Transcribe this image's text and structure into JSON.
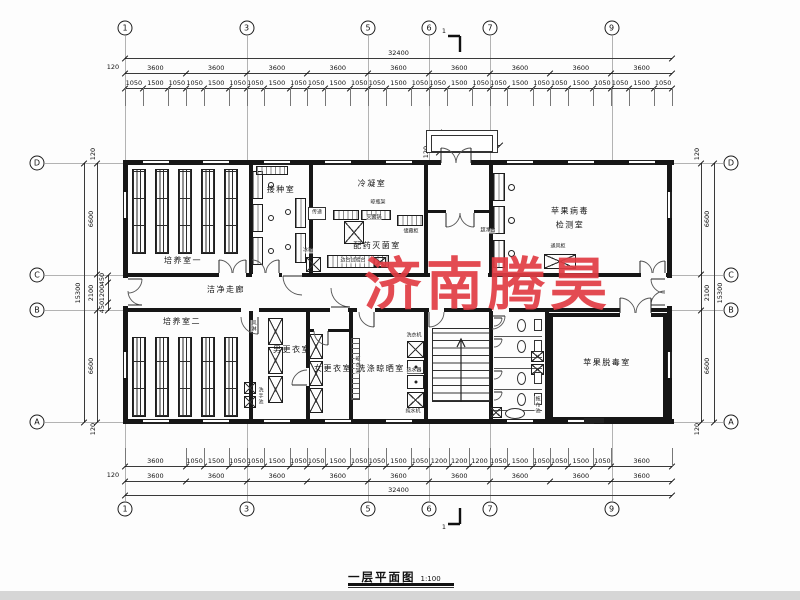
{
  "drawing": {
    "title": "一层平面图",
    "scale": "1:100",
    "watermark": "济南腾昊",
    "watermark_color": "#e13c44",
    "section_marker": "1"
  },
  "grid": {
    "top": [
      {
        "n": "1",
        "x": 125
      },
      {
        "n": "3",
        "x": 246.5
      },
      {
        "n": "5",
        "x": 368
      },
      {
        "n": "6",
        "x": 429
      },
      {
        "n": "7",
        "x": 490
      },
      {
        "n": "9",
        "x": 611.5
      }
    ],
    "bottom": [
      {
        "n": "1",
        "x": 125
      },
      {
        "n": "3",
        "x": 246.5
      },
      {
        "n": "5",
        "x": 368
      },
      {
        "n": "6",
        "x": 429
      },
      {
        "n": "7",
        "x": 490
      },
      {
        "n": "9",
        "x": 611.5
      }
    ],
    "left": [
      {
        "n": "D",
        "y": 163
      },
      {
        "n": "C",
        "y": 275
      },
      {
        "n": "B",
        "y": 310
      },
      {
        "n": "A",
        "y": 422
      }
    ],
    "right": [
      {
        "n": "D",
        "y": 163
      },
      {
        "n": "C",
        "y": 275
      },
      {
        "n": "B",
        "y": 310
      },
      {
        "n": "A",
        "y": 422
      }
    ]
  },
  "dimensions": {
    "top": {
      "total": "32400",
      "edge": "120",
      "bays": [
        "3600",
        "3600",
        "3600",
        "3600",
        "3600",
        "3600",
        "3600",
        "3600",
        "3600"
      ],
      "subs": [
        "1050",
        "1500",
        "1050",
        "1050",
        "1500",
        "1050",
        "1050",
        "1500",
        "1050",
        "1050",
        "1500",
        "1050",
        "1050",
        "1500",
        "1050",
        "1050",
        "1500",
        "1050",
        "1050",
        "1500",
        "1050",
        "1050",
        "1500",
        "1050",
        "1050",
        "1500",
        "1050"
      ]
    },
    "bottom": {
      "total": "32400",
      "edge": "120",
      "bays": [
        "3600",
        "3600",
        "3600",
        "3600",
        "3600",
        "3600",
        "3600",
        "3600",
        "3600"
      ],
      "subs": [
        "3600",
        "1050",
        "1500",
        "1050",
        "1050",
        "1500",
        "1050",
        "1050",
        "1500",
        "1050",
        "1050",
        "1500",
        "1050",
        "1200",
        "1200",
        "1200",
        "1050",
        "1500",
        "1050",
        "1050",
        "1500",
        "1050",
        "3600"
      ]
    },
    "left": {
      "total": "15300",
      "edge_top": "120",
      "edge_bottom": "120",
      "main": [
        "6600",
        "2100",
        "6600"
      ],
      "subs": [
        "450",
        "1200",
        "450"
      ]
    },
    "right": {
      "total": "15300",
      "edge_top": "120",
      "edge_bottom": "120",
      "main": [
        "6600",
        "2100",
        "6600"
      ]
    },
    "entrance": {
      "depth": "1200",
      "wall_offset": "120",
      "splits": [
        "300",
        "300"
      ]
    }
  },
  "rooms": [
    {
      "name": "culture-room-1",
      "label": "培养室一",
      "x": 183,
      "y": 261
    },
    {
      "name": "inoculation-room",
      "label": "接种室",
      "x": 281,
      "y": 190
    },
    {
      "name": "condensing-room",
      "label": "冷凝室",
      "x": 372,
      "y": 184
    },
    {
      "name": "medicine-sterilization-room",
      "label": "配药灭菌室",
      "x": 377,
      "y": 246
    },
    {
      "name": "apple-virus-test-room",
      "label": "苹果病毒",
      "label2": "检测室",
      "x": 570,
      "y": 219
    },
    {
      "name": "clean-corridor",
      "label": "洁净走廊",
      "x": 226,
      "y": 290
    },
    {
      "name": "culture-room-2",
      "label": "培养室二",
      "x": 182,
      "y": 322
    },
    {
      "name": "mens-changing-room",
      "label": "男更衣室",
      "x": 292,
      "y": 350
    },
    {
      "name": "womens-changing-room",
      "label": "女更衣室",
      "x": 333,
      "y": 369
    },
    {
      "name": "washing-drying-room",
      "label": "洗涤晾晒室",
      "x": 381,
      "y": 369
    },
    {
      "name": "apple-detox-room",
      "label": "苹果脱毒室",
      "x": 607,
      "y": 363
    }
  ],
  "equipment": [
    {
      "name": "bottle-rack-label",
      "label": "晾瓶架",
      "x": 378,
      "y": 203,
      "v": 0
    },
    {
      "name": "sterilizer-label",
      "label": "灭菌锅",
      "x": 374,
      "y": 218,
      "v": 0
    },
    {
      "name": "storage-cabinet-label",
      "label": "储藏柜",
      "x": 411,
      "y": 232,
      "v": 0
    },
    {
      "name": "pass-window-label",
      "label": "传递",
      "x": 317,
      "y": 213,
      "v": 0
    },
    {
      "name": "fridge-label",
      "label": "冰箱",
      "x": 308,
      "y": 251,
      "v": 0
    },
    {
      "name": "side-bench-label",
      "label": "边台试验台",
      "x": 353,
      "y": 261,
      "v": 0
    },
    {
      "name": "clean-bench-label",
      "label": "超净台",
      "x": 488,
      "y": 231,
      "v": 0
    },
    {
      "name": "fume-hood-label",
      "label": "通风柜",
      "x": 558,
      "y": 247,
      "v": 0
    },
    {
      "name": "air-shower-label",
      "label": "风淋",
      "x": 253,
      "y": 326,
      "v": 1
    },
    {
      "name": "hand-wash-label",
      "label": "洗手池",
      "x": 260,
      "y": 396,
      "v": 1
    },
    {
      "name": "drying-rack-label",
      "label": "晾衣架",
      "x": 357,
      "y": 365,
      "v": 1
    },
    {
      "name": "washing-machine-label",
      "label": "洗衣机",
      "x": 414,
      "y": 336,
      "v": 0
    },
    {
      "name": "water-heater-label",
      "label": "热水器",
      "x": 414,
      "y": 371,
      "v": 0
    },
    {
      "name": "pure-water-label",
      "label": "纯水机",
      "x": 413,
      "y": 412,
      "v": 0
    },
    {
      "name": "mop-sink-label",
      "label": "拖布池",
      "x": 537,
      "y": 405,
      "v": 1
    }
  ]
}
